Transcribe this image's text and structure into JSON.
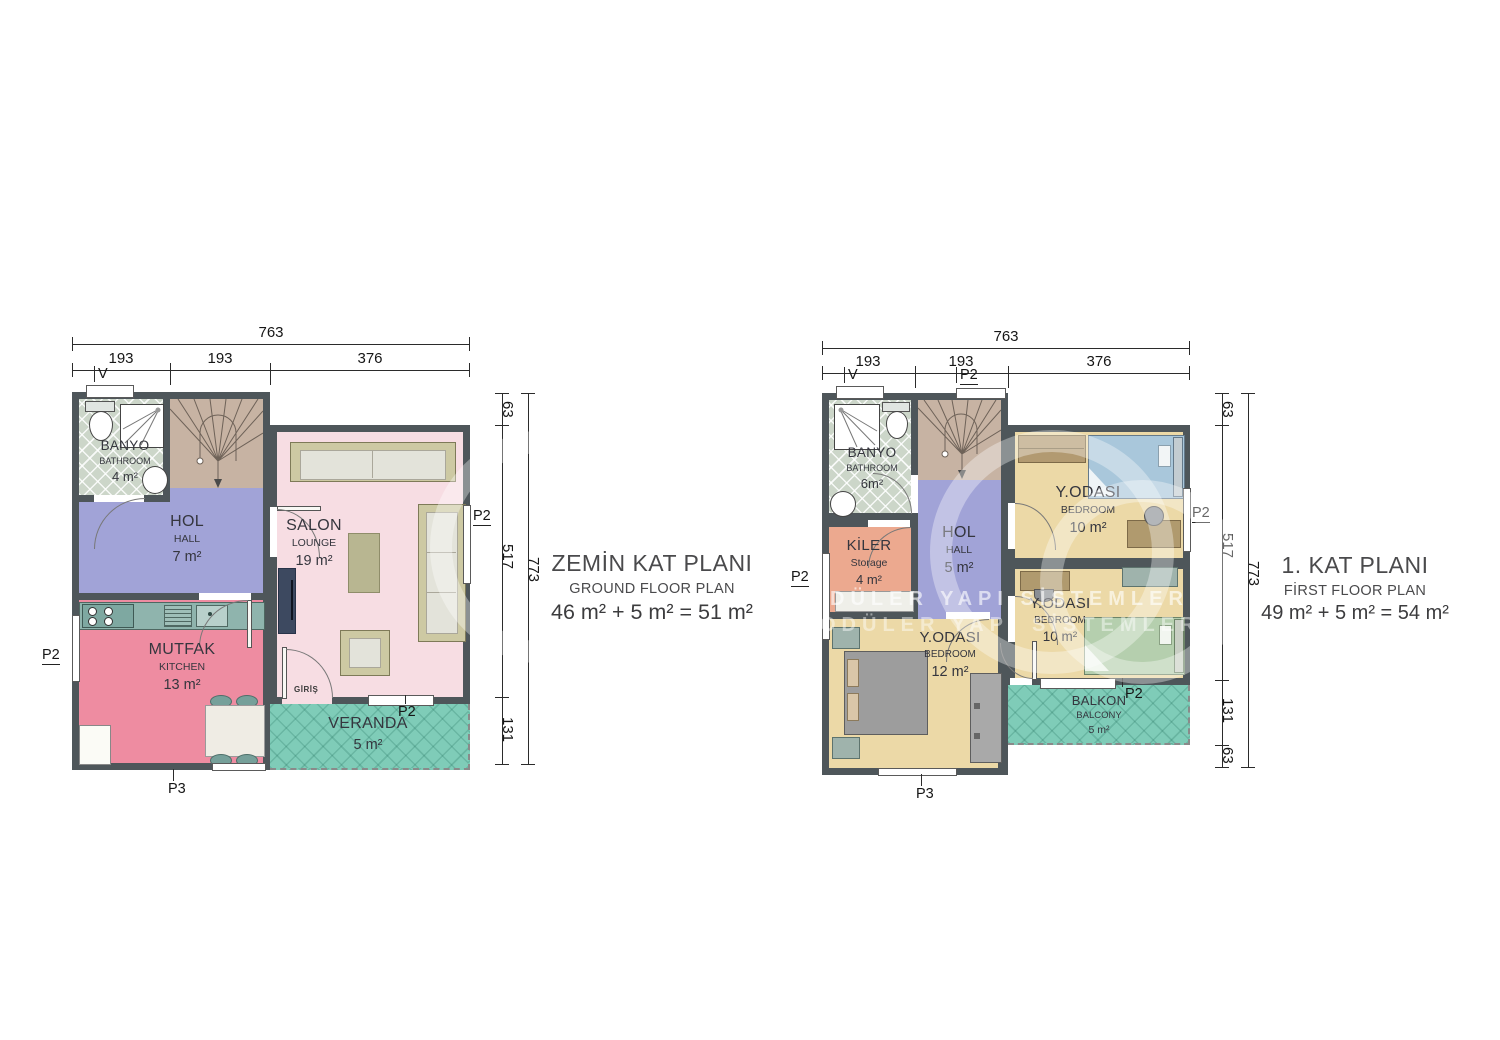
{
  "colors": {
    "wall": "#4e565a",
    "hall": "#a1a3d7",
    "salon": "#f7dde3",
    "kitchen": "#ee8ca1",
    "bathroom": "#ccd6c9",
    "stairs": "#c7b3a3",
    "veranda": "#7fccb8",
    "kiler": "#eca98f",
    "bedroom": "#ecd9a7"
  },
  "watermark": {
    "row1": "DÜLER YAPI SİSTEMLERİ",
    "row2": "ODÜLER YAPI SİSTEMLERİ"
  },
  "ground": {
    "title": "ZEMİN KAT PLANI",
    "subtitle": "GROUND FLOOR PLAN",
    "area_eq": "46 m² + 5 m² = 51 m²",
    "dim_total_w": "763",
    "dim_segs_w": [
      "193",
      "193",
      "376"
    ],
    "dim_total_h": "773",
    "dim_segs_h": [
      "63",
      "517",
      "131"
    ],
    "labels": {
      "v": "V",
      "p2": "P2",
      "p3": "P3",
      "giris": "GİRİŞ"
    },
    "rooms": {
      "banyo": {
        "name": "BANYO",
        "en": "BATHROOM",
        "area": "4 m²"
      },
      "hol": {
        "name": "HOL",
        "en": "HALL",
        "area": "7 m²"
      },
      "salon": {
        "name": "SALON",
        "en": "LOUNGE",
        "area": "19 m²"
      },
      "mutfak": {
        "name": "MUTFAK",
        "en": "KITCHEN",
        "area": "13 m²"
      },
      "veranda": {
        "name": "VERANDA",
        "en": "",
        "area": "5 m²"
      }
    }
  },
  "first": {
    "title": "1. KAT PLANI",
    "subtitle": "FİRST FLOOR PLAN",
    "area_eq": "49 m² + 5 m² = 54 m²",
    "dim_total_w": "763",
    "dim_segs_w": [
      "193",
      "193",
      "376"
    ],
    "dim_total_h": "773",
    "dim_segs_h": [
      "63",
      "517",
      "131",
      "63"
    ],
    "labels": {
      "v": "V",
      "p2": "P2",
      "p3": "P3"
    },
    "rooms": {
      "banyo": {
        "name": "BANYO",
        "en": "BATHROOM",
        "area": "6m²"
      },
      "kiler": {
        "name": "KİLER",
        "en": "Storage",
        "area": "4 m²"
      },
      "hol": {
        "name": "HOL",
        "en": "HALL",
        "area": "5 m²"
      },
      "bed1": {
        "name": "Y.ODASI",
        "en": "BEDROOM",
        "area": "10 m²"
      },
      "bed2": {
        "name": "Y.ODASI",
        "en": "BEDROOM",
        "area": "10 m²"
      },
      "bed3": {
        "name": "Y.ODASI",
        "en": "BEDROOM",
        "area": "12 m²"
      },
      "balkon": {
        "name": "BALKON",
        "en": "BALCONY",
        "area": "5 m²"
      }
    }
  }
}
